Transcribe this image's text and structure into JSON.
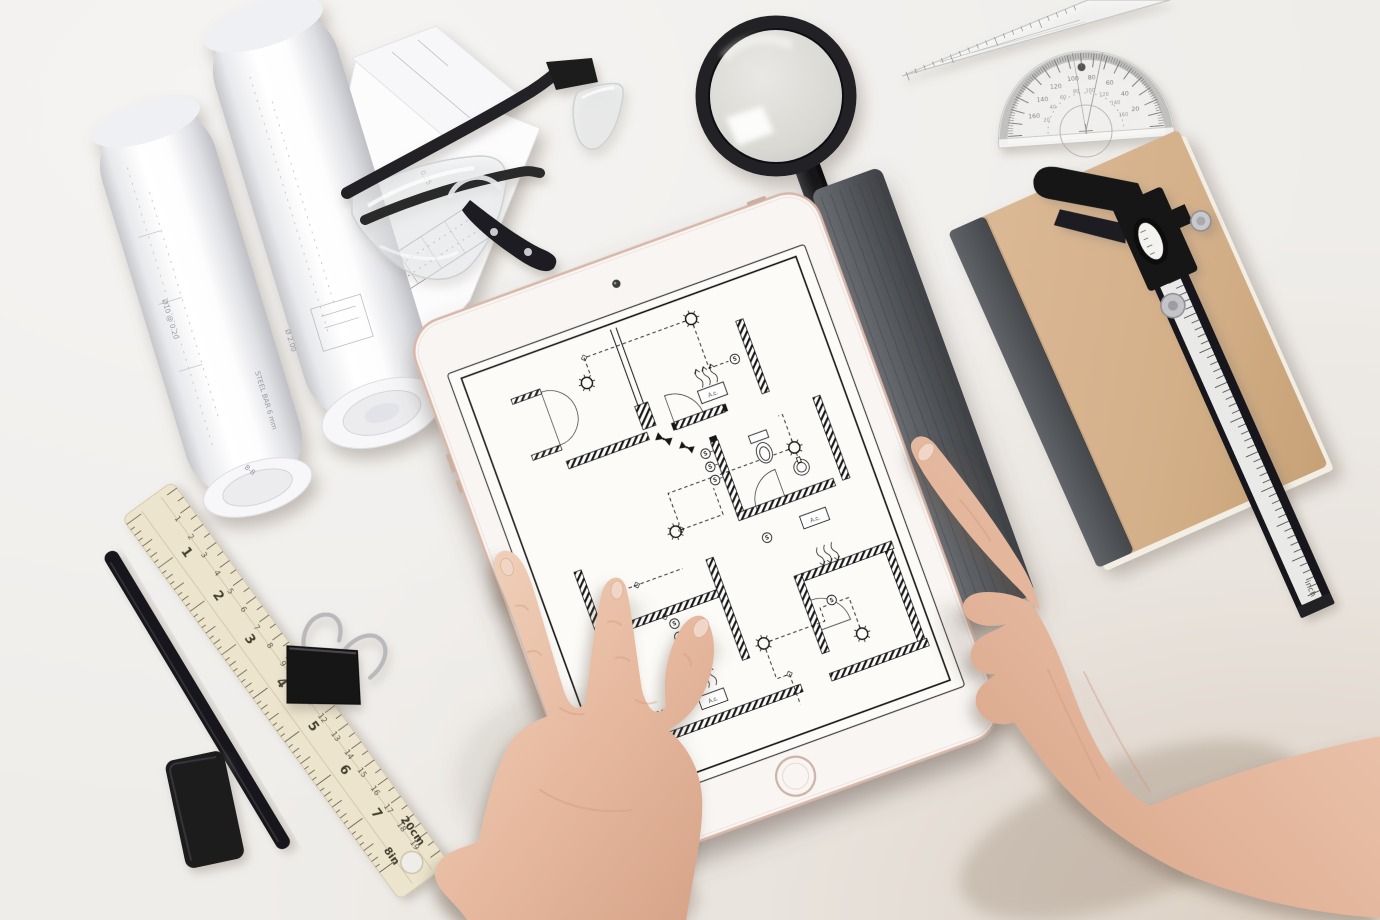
{
  "scene": {
    "description": "Top-down photo of two hands holding a tablet that displays an architectural electrical floor plan, on a white desk with drafting tools: rolled blueprints, safety glasses, magnifying glass, set square, protractor, kraft notebook with vernier caliper, wooden ruler, pencil, eraser and a binder clip",
    "desk_color": "#efedea",
    "corner_shade_color": "#c9b29c"
  },
  "tablet": {
    "name": "tablet showing floor plan",
    "bezel_color": "#f8f5f3",
    "edge_color": "#d8b7a9",
    "cover_color": "#55585c",
    "screen_color": "#fcfbf8",
    "floorplan": {
      "type": "electrical floor plan",
      "line_color": "#161616",
      "ac_label": "A.c.",
      "switch_label": "S",
      "features": [
        "hatched walls",
        "ceiling lights",
        "switch circles",
        "dashed wiring runs",
        "door swings",
        "toilet",
        "sink",
        "air-conditioner boxes with airflow arrows"
      ]
    }
  },
  "blueprint_rolls": {
    "paper_color": "#fbfbfc",
    "annotations": [
      "Ø10 @ 0.20",
      "Ø 2.00",
      "STEEL BAR 6 mm",
      "B-B",
      "0.25"
    ]
  },
  "safety_glasses": {
    "frame_color": "#242426",
    "lens_tint": "rgba(236,240,242,0.45)"
  },
  "magnifier": {
    "rim_color": "#232325",
    "lens_color": "#dddcd7",
    "handle_color": "#1c1c1e"
  },
  "set_square": {
    "color": "rgba(252,253,253,0.55)",
    "edge_color": "#c6c8c8"
  },
  "protractor": {
    "rim_color": "#b9b9b7",
    "degree_numbers_outer": [
      20,
      40,
      60,
      80,
      100,
      120,
      140,
      160
    ],
    "degree_numbers_inner": [
      160,
      140,
      120,
      100,
      80,
      60,
      40,
      20
    ]
  },
  "notebook": {
    "cover_color": "#d6b28c",
    "spine_color": "#54575b",
    "pages_color": "#f3eee4"
  },
  "caliper": {
    "body_color": "#18181b",
    "scale_color": "#e9e9e7",
    "unit_label": "inch"
  },
  "ruler": {
    "body_color": "#ece4cd",
    "inch_numbers": [
      1,
      2,
      3,
      4,
      5,
      6,
      7
    ],
    "cm_numbers": [
      1,
      2,
      3,
      4,
      5,
      6,
      7,
      8,
      9,
      10,
      11,
      12,
      13,
      14,
      15,
      16,
      17,
      18,
      19
    ],
    "end_cm_label": "20cm",
    "end_in_label": "8in"
  },
  "pencil": {
    "color": "#18181a"
  },
  "eraser": {
    "color": "#1b1b1e"
  },
  "binder_clip": {
    "body_color": "#141416",
    "handle_color": "#b9b9bd"
  },
  "hands": {
    "skin_light": "#f2d4bf",
    "skin_mid": "#e6b89e",
    "skin_shadow": "#cf9a80"
  }
}
